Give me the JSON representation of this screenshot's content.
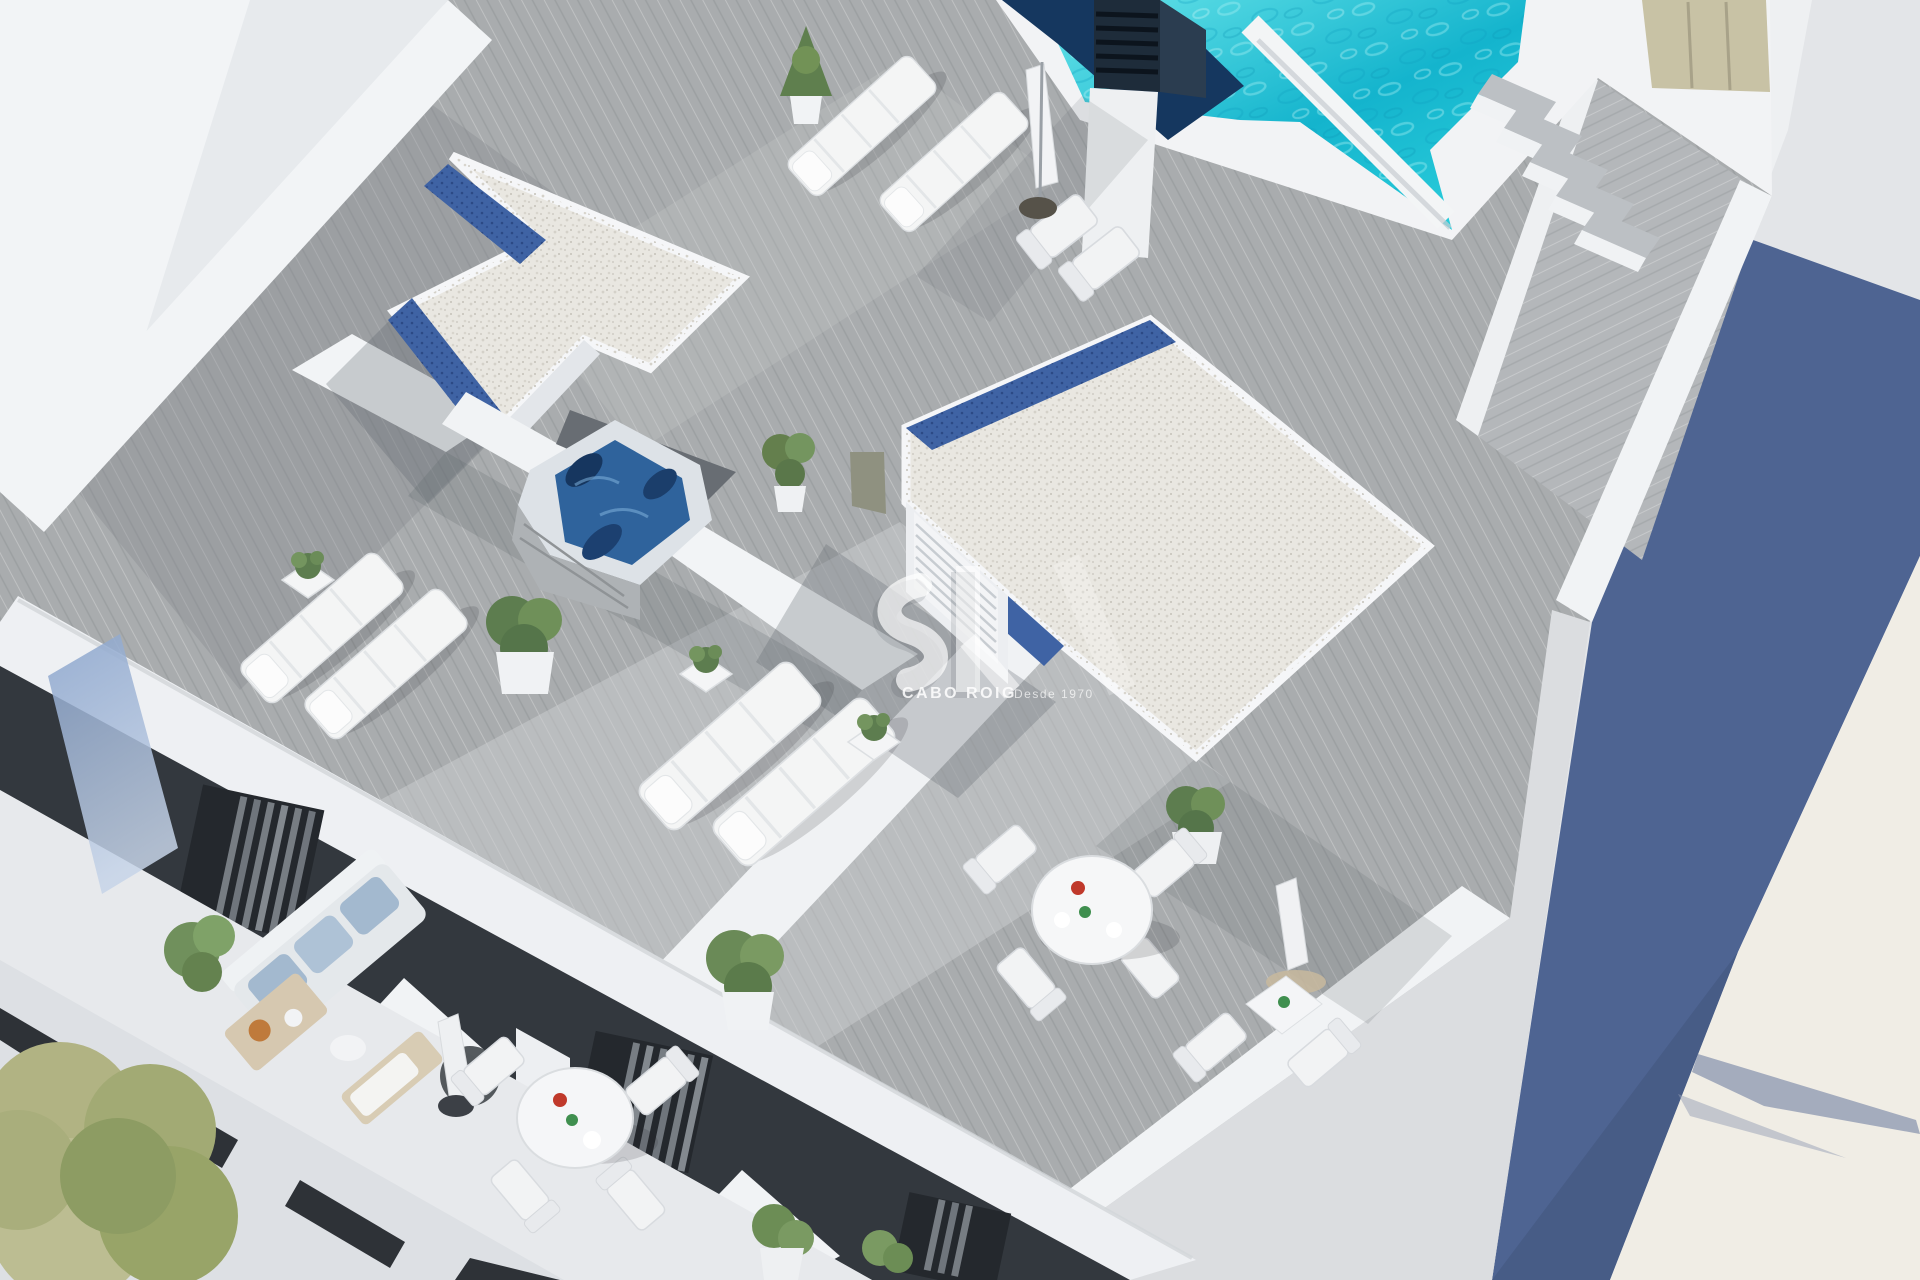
{
  "watermark": {
    "brand": "CABO ROIG",
    "tagline": "Desde 1970"
  },
  "palette": {
    "background": "#e3e5e8",
    "deck": "#a9acae",
    "deck_sun": "#cbcdcf",
    "parapet": "#f2f4f6",
    "pool_light": "#6ae5ea",
    "pool_deep": "#14b4cd",
    "pool_navy": "#15375f",
    "gravel": "#e9e7e1",
    "gravel_blue": "#3f63a4",
    "jacuzzi_water": "#2f639c",
    "balcony_dark": "#33383e",
    "shadow_blue_wall": "#4e6492",
    "cream_wall": "#f0ede5",
    "plant_green": "#5d7d4f",
    "tree_olive": "#b1b383",
    "khaki_door": "#c8c2a5"
  },
  "scene": {
    "objects": [
      "swimming pool",
      "pool divider wall",
      "ventilation chimney",
      "pool stairs",
      "wood roof deck",
      "roof walkway",
      "gravel roof with blue border",
      "stair-core roof block",
      "louvered door",
      "jacuzzi",
      "sun loungers",
      "deck chairs",
      "closed parasols",
      "potted plants",
      "round dining set",
      "square bistro table",
      "penthouse balconies",
      "outdoor sofa",
      "coffee table",
      "olive tree",
      "neighbour building shadow wall"
    ]
  }
}
